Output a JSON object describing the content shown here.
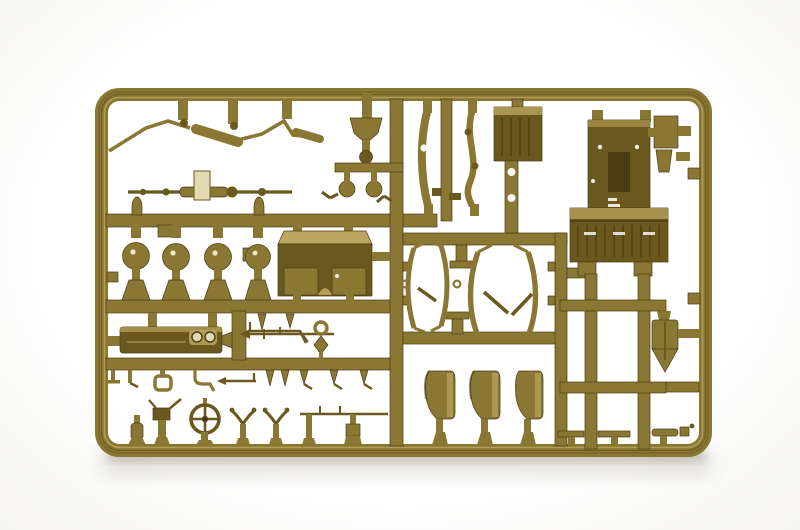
{
  "image": {
    "type": "product-photograph",
    "subject": "Olive-drab injection-molded plastic model kit sprue (parts tree) for a 1/35 military vehicle kit, shot on a white studio background with a soft shadow beneath the bottom rail",
    "alt": "Rectangular olive-green plastic sprue frame filled with runners and many small unpainted model parts: firewall panel with grille, ladder frame, shovel, engine hood, dashboard with gauges, four road wheels, axle, exhaust pipe, leaf springs, radiator panel, windshield bows, three seat backs, steering wheel and assorted small fittings",
    "text_content": "none"
  },
  "palette": {
    "bg": "#fdfdfc",
    "pLight": "#baa65e",
    "pMid": "#8a7733",
    "pDark": "#6b581f",
    "pDeep": "#4a3c12",
    "pPale": "#e2dab2",
    "shadow": "#8d8673"
  },
  "sprue": {
    "frame": {
      "left": 95,
      "top": 88,
      "right": 712,
      "bottom": 457,
      "corner_radius": 20,
      "bar_thickness": 13
    },
    "parts": [
      {
        "name": "exhaust-pipe",
        "count": 1,
        "region": "top-left, bent rod with muffler bulges"
      },
      {
        "name": "front-axle",
        "count": 1,
        "region": "upper-left, thin rod with pale center tag"
      },
      {
        "name": "air-intake-funnel",
        "count": 1,
        "region": "top-center with two ball fittings"
      },
      {
        "name": "leaf-springs",
        "count": 2,
        "region": "top-center verticals"
      },
      {
        "name": "chassis-rail-with-holes",
        "count": 1,
        "region": "top-center"
      },
      {
        "name": "radiator-panel",
        "count": 1,
        "region": "top-center rectangle"
      },
      {
        "name": "firewall-panel-with-grille",
        "count": 1,
        "region": "top-right large flat part"
      },
      {
        "name": "accessory-box",
        "count": 1,
        "region": "top-right beside frame rail"
      },
      {
        "name": "engine-hood",
        "count": 1,
        "region": "center-left large box part"
      },
      {
        "name": "road-wheel",
        "count": 4,
        "region": "middle-left row"
      },
      {
        "name": "dashboard-with-gauges",
        "count": 1,
        "region": "center-left long dark part"
      },
      {
        "name": "tow-bar-rod",
        "count": 1,
        "region": "center"
      },
      {
        "name": "tie-rod",
        "count": 1,
        "region": "center thin rod with arrow ends"
      },
      {
        "name": "ring-fitting",
        "count": 1,
        "region": "center"
      },
      {
        "name": "windshield-bow",
        "count": 4,
        "region": "center-right curved strips"
      },
      {
        "name": "seat-back",
        "count": 3,
        "region": "bottom-center curved panels"
      },
      {
        "name": "ladder-frame",
        "count": 1,
        "region": "right, two rails with rungs"
      },
      {
        "name": "shovel",
        "count": 1,
        "region": "right of ladder"
      },
      {
        "name": "steering-wheel",
        "count": 1,
        "region": "bottom-left ring with spokes"
      },
      {
        "name": "gun-mount-fitting",
        "count": 1,
        "region": "bottom-left"
      },
      {
        "name": "shackle-hook",
        "count": 1,
        "region": "lower-left hanging row"
      },
      {
        "name": "small-pin-fittings",
        "count": 12,
        "region": "hanging rows and bottom rail"
      },
      {
        "name": "bottle-fitting",
        "count": 1,
        "region": "bottom-left"
      },
      {
        "name": "fork-bracket",
        "count": 2,
        "region": "bottom rail"
      },
      {
        "name": "linkage-rod",
        "count": 1,
        "region": "bottom rail"
      }
    ]
  }
}
